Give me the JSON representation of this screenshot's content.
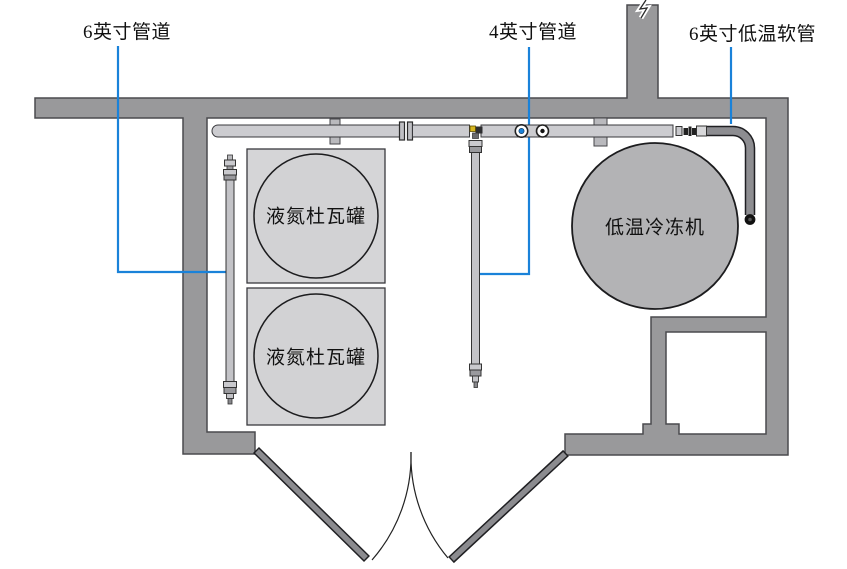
{
  "diagram": {
    "type": "floor-plan",
    "callouts": [
      {
        "id": "pipe6",
        "label": "6英寸管道"
      },
      {
        "id": "pipe4",
        "label": "4英寸管道"
      },
      {
        "id": "hose6",
        "label": "6英寸低温软管"
      }
    ],
    "equipment": [
      {
        "id": "dewar1",
        "label": "液氮杜瓦罐",
        "shape": "circle-in-square"
      },
      {
        "id": "dewar2",
        "label": "液氮杜瓦罐",
        "shape": "circle-in-square"
      },
      {
        "id": "chiller",
        "label": "低温冷冻机",
        "shape": "circle"
      }
    ],
    "icons": [
      "valve-blue-handle-icon",
      "valve-black-handle-icon",
      "pipe-break-mark-icon"
    ],
    "colors": {
      "wall_fill": "#99999b",
      "wall_stroke": "#4a4a4e",
      "door_fill": "#8b8b8f",
      "pipe_fill": "#ccccd0",
      "pipe_stroke": "#39393d",
      "tank_box_fill": "#d5d5d7",
      "tank_circle_fill": "#d2d2d4",
      "chiller_fill": "#b3b3b5",
      "hose_fill": "#8d8d91",
      "leader_line_blue": "#1a82d9",
      "valve_dot_blue": "#1a82d9",
      "elbow_fitting_yellow": "#d8b822",
      "text": "#111111",
      "background": "#ffffff"
    }
  }
}
